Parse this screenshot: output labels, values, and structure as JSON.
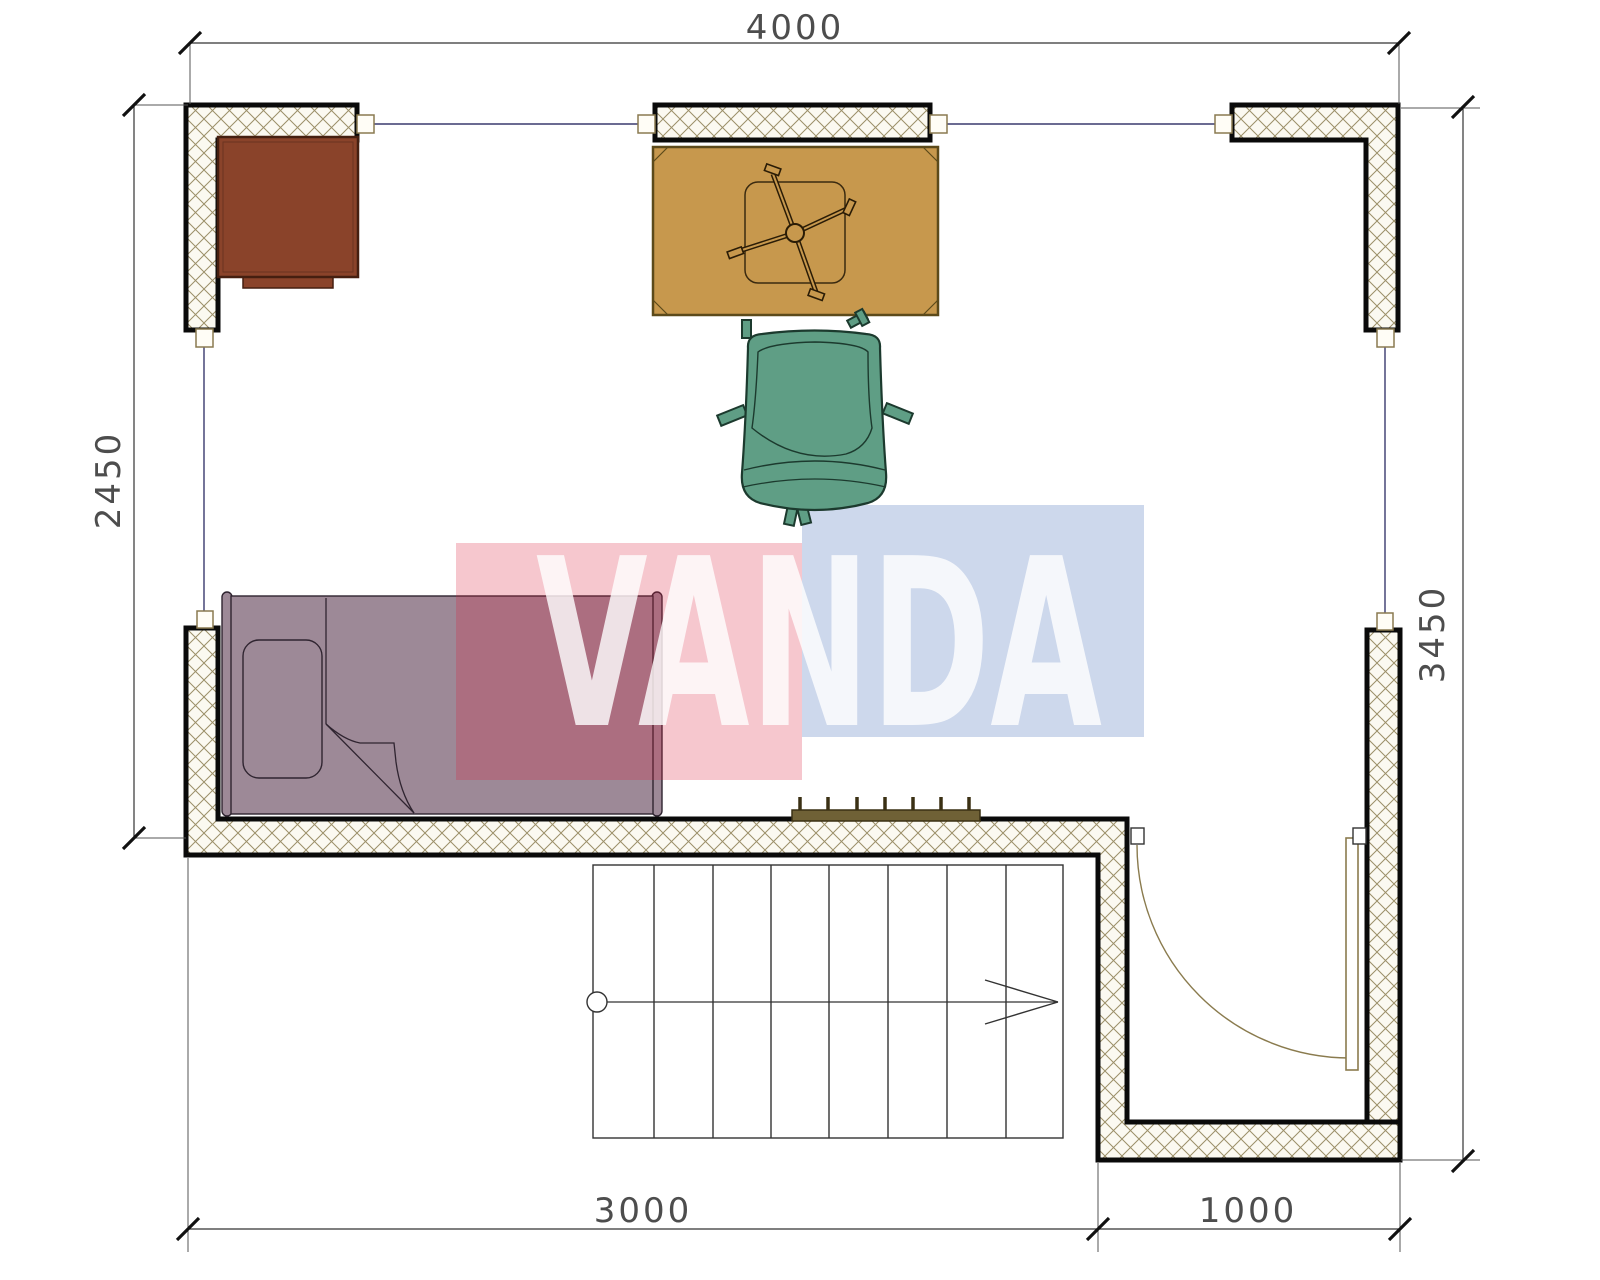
{
  "document": {
    "type": "architectural-floor-plan",
    "units": "mm"
  },
  "dimensions": {
    "top": "4000",
    "left": "2450",
    "right": "3450",
    "bottom_left": "3000",
    "bottom_right": "1000"
  },
  "watermark": {
    "text": "VANDA",
    "red_block_color": "#dc1e3c",
    "blue_block_color": "#466eb9",
    "text_color": "#ffffff"
  },
  "furniture": {
    "desk": "desk",
    "table": "table with swivel base",
    "chair": "office chair",
    "bed": "single bed with pillow",
    "radiator": "radiator",
    "stairs": "staircase with up arrow",
    "door": "swing door"
  },
  "colors": {
    "desk": "#8a432a",
    "table": "#c7984d",
    "chair": "#5f9e85",
    "bed": "#9d8997",
    "radiator": "#6f6136",
    "wall_hatch": "#9b8f68",
    "wall_fill": "#fbf9f1",
    "wall_border": "#0a0a0a",
    "window_line": "#3a3a6e",
    "dimension_line": "#333333"
  }
}
